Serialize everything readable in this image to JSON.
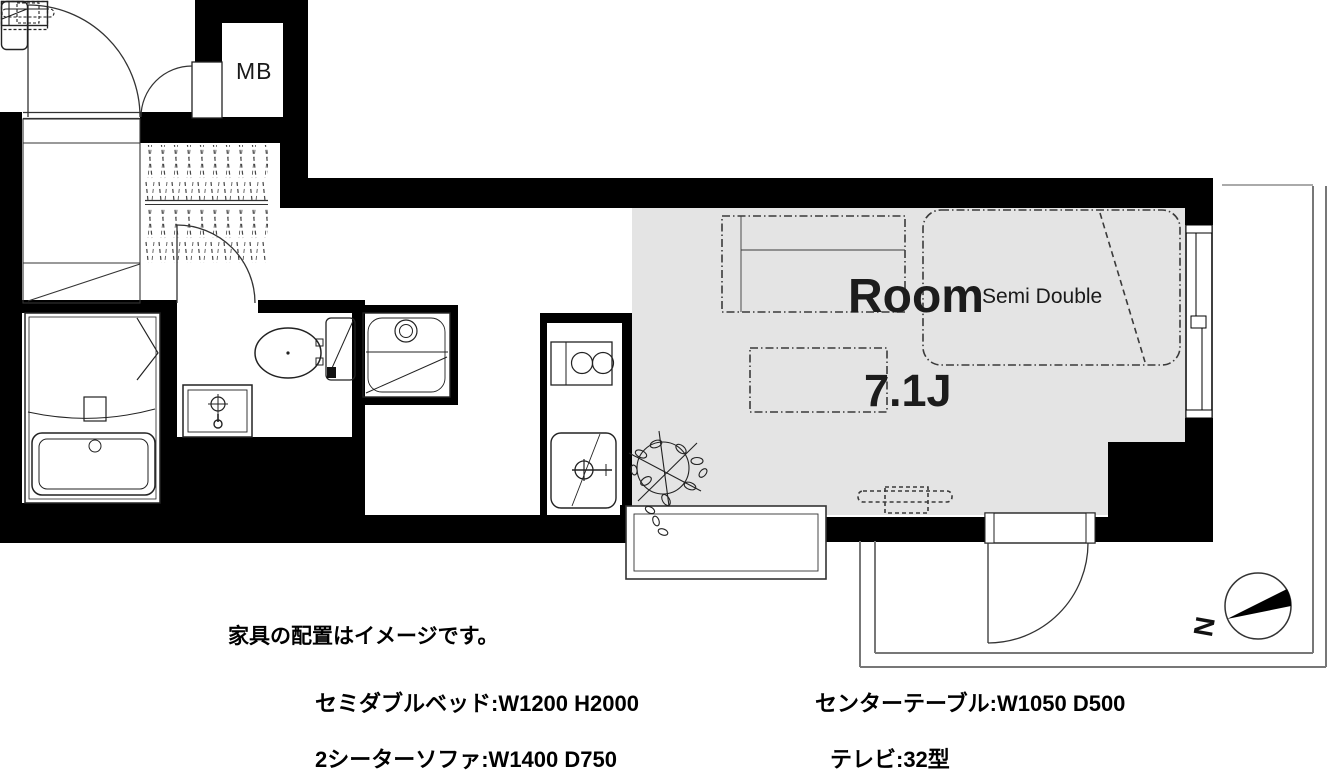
{
  "floor_plan": {
    "room": {
      "name": "Room",
      "size": "7.1J",
      "bed_type": "Semi Double"
    },
    "labels": {
      "meter_box": "MB",
      "north": "N"
    },
    "colors": {
      "wall": "#000000",
      "room_floor": "#e4e4e4",
      "furniture_dash": "#3a3a3a",
      "balcony_line": "#777777"
    },
    "symbols": [
      "entrance-door",
      "meter-box",
      "shoe-storage-hatch",
      "closet",
      "bathtub",
      "washbasin",
      "toilet",
      "washing-machine-pan",
      "gas-stove",
      "kitchen-sink",
      "sliding-window",
      "bay-window",
      "balcony-door",
      "plant",
      "north-compass",
      "bed",
      "sofa",
      "center-table",
      "tv"
    ]
  },
  "legend": {
    "note": "家具の配置はイメージです。",
    "items": [
      {
        "id": "bed",
        "label": "セミダブルベッド:W1200 H2000"
      },
      {
        "id": "sofa",
        "label": "2シーターソファ:W1400 D750"
      },
      {
        "id": "table",
        "label": "センターテーブル:W1050 D500"
      },
      {
        "id": "tv",
        "label": "テレビ:32型"
      }
    ]
  }
}
